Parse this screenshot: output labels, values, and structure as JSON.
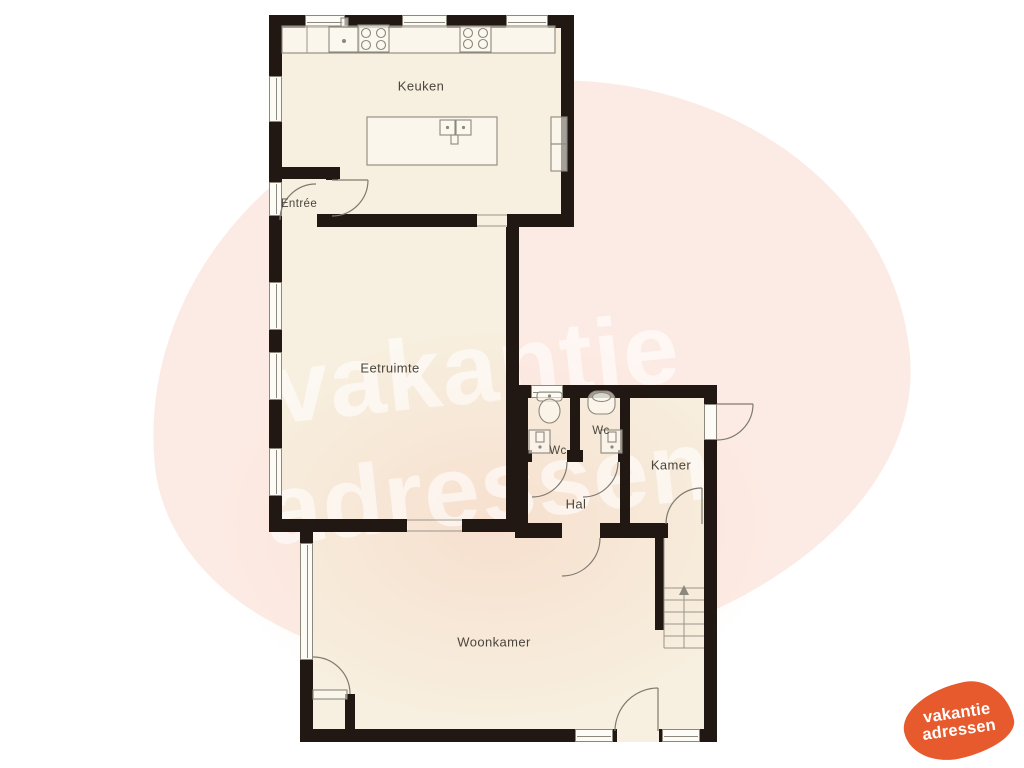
{
  "floorplan": {
    "rooms": {
      "keuken": {
        "label": "Keuken"
      },
      "entree": {
        "label": "Entrée"
      },
      "eetruimte": {
        "label": "Eetruimte"
      },
      "wc_left": {
        "label": "Wc"
      },
      "wc_right": {
        "label": "Wc"
      },
      "kamer": {
        "label": "Kamer"
      },
      "hal": {
        "label": "Hal"
      },
      "woonkamer": {
        "label": "Woonkamer"
      }
    }
  },
  "watermark": {
    "line1": "vakantie",
    "line2": "adressen"
  },
  "logo": {
    "line1": "vakantie",
    "line2": "adressen"
  },
  "colors": {
    "wall": "#221813",
    "floor": "#f7efdf",
    "blob": "#fcebe4",
    "logo_orange": "#e65a2d",
    "watermark_white": "rgba(255,255,255,0.58)",
    "line": "#8d887c",
    "label": "#4a453c"
  }
}
